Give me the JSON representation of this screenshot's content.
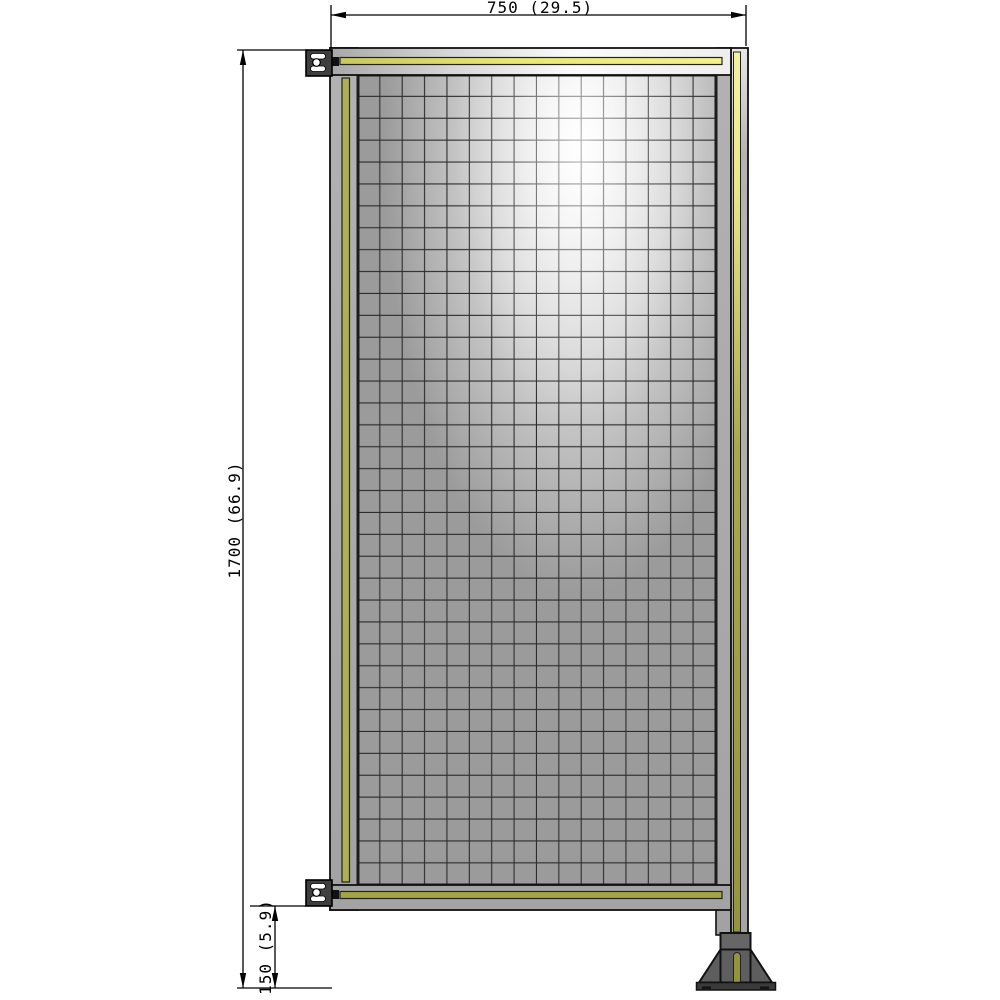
{
  "drawing": {
    "kind": "technical-drawing-fence-panel",
    "dimensions": {
      "width": {
        "label": "750 (29.5)",
        "value_mm": 750,
        "value_in": 29.5
      },
      "height": {
        "label": "1700 (66.9)",
        "value_mm": 1700,
        "value_in": 66.9
      },
      "floor_offset": {
        "label": "150 (5.9)",
        "value_mm": 150,
        "value_in": 5.9
      }
    },
    "colors": {
      "background": "#ffffff",
      "dimension_line": "#000000",
      "outline": "#111111",
      "frame_gray": "#a9a9a9",
      "frame_gray_dark": "#a3a3a3",
      "mesh_gray": "#9b9b9b",
      "grid_line": "#2c2c2c",
      "stripe_olive": "#b1b050",
      "stripe_olive_dark": "#a6a545",
      "stripe_bright": "#f0ec8c",
      "stripe_post_top": "#f4f0a2",
      "stripe_post_bottom": "#95943e",
      "foot_gray": "#5e5e5e",
      "foot_collar": "#666666",
      "foot_base": "#3a3a3a",
      "bracket_gray": "#3f3f3f",
      "slot_white": "#ffffff"
    }
  }
}
